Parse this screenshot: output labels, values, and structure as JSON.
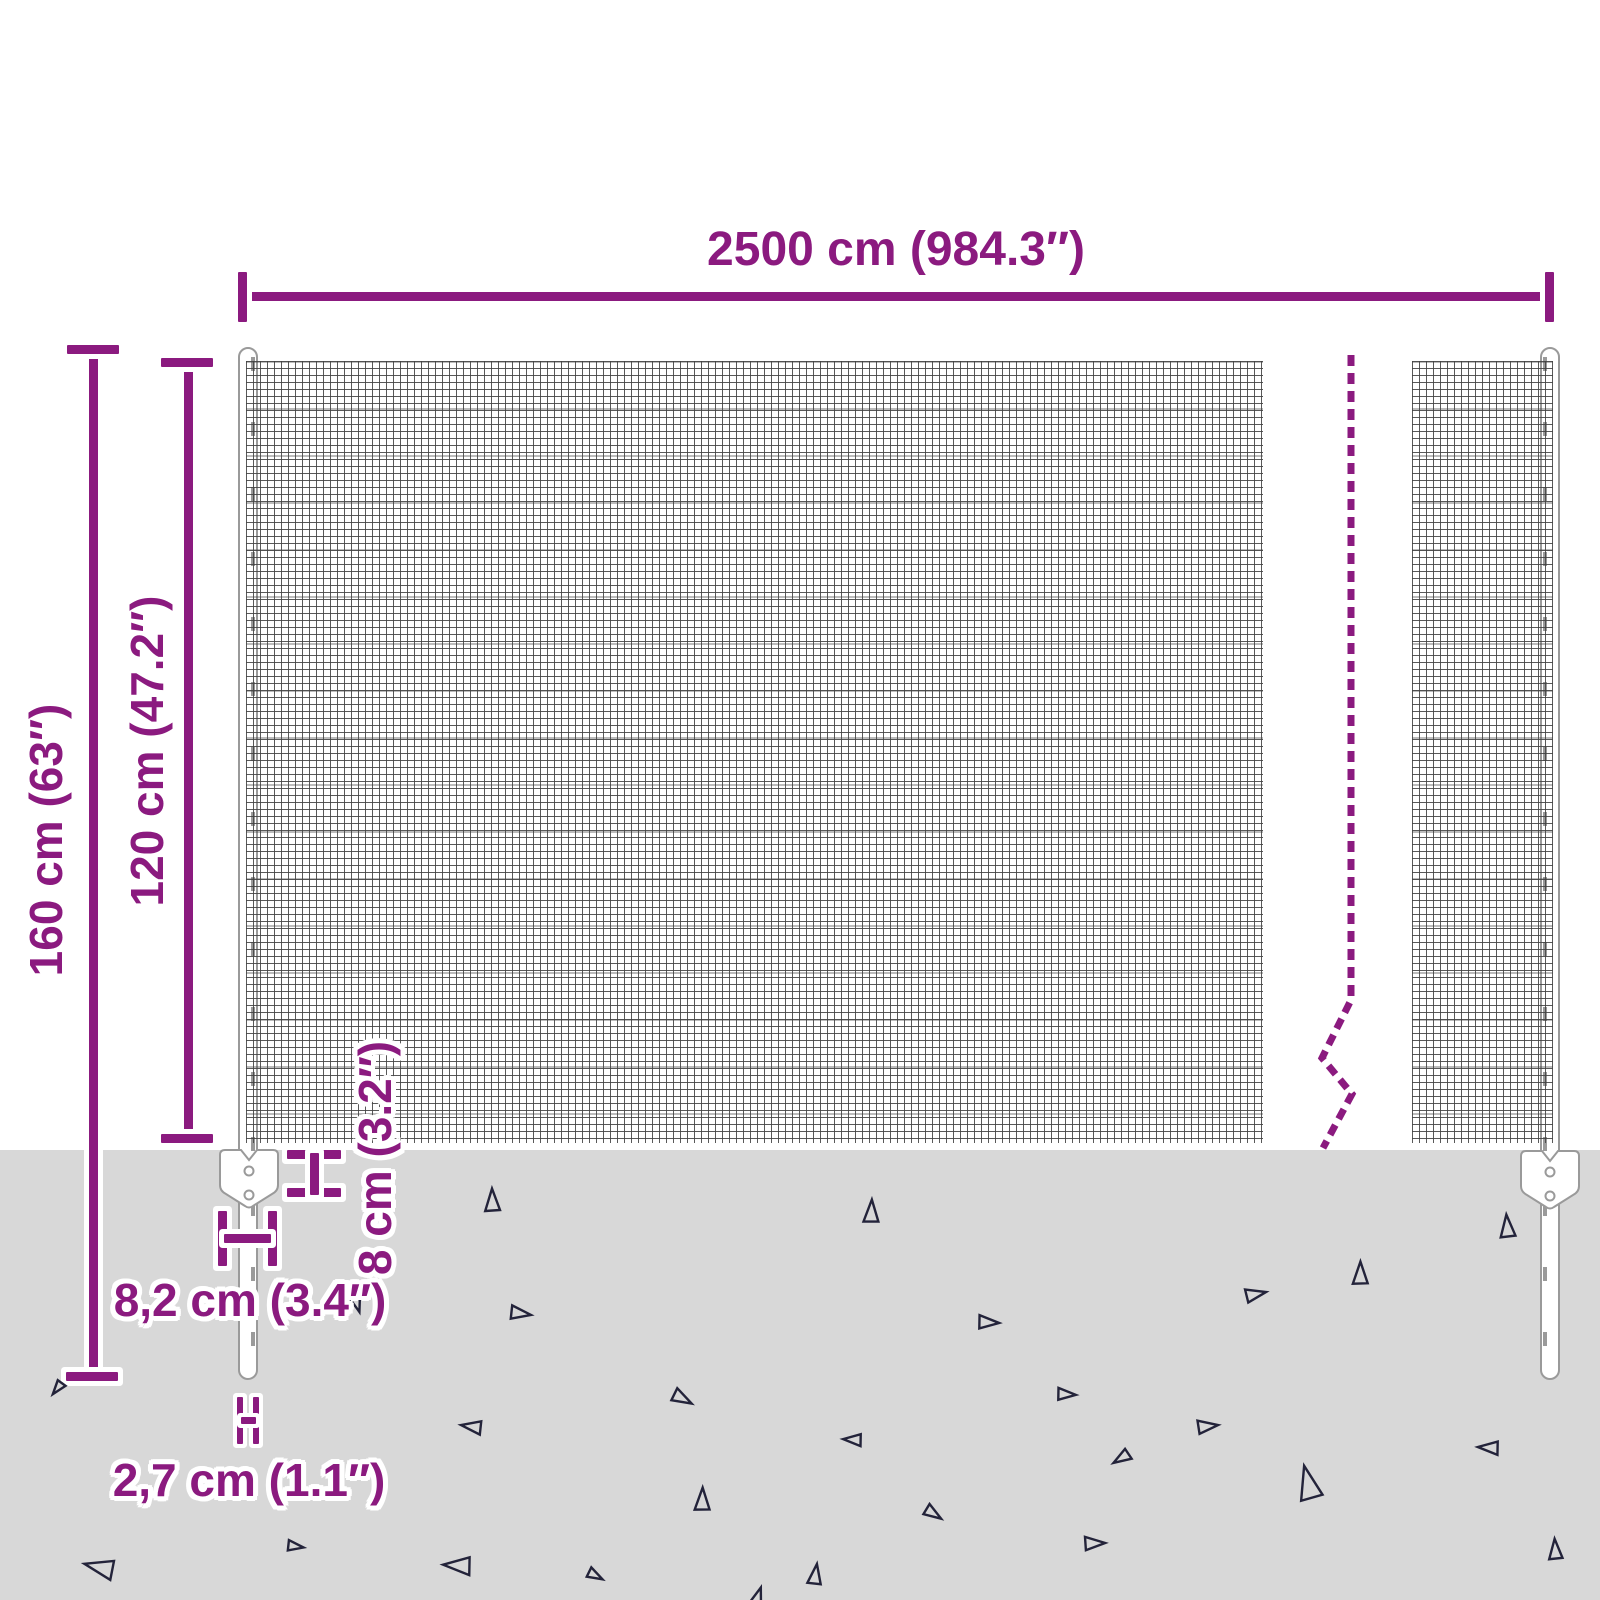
{
  "title": "Wire mesh fence dimension diagram",
  "colors": {
    "accent": "#8b1a7f",
    "ground": "#d8d8d8",
    "mesh_line": "#424242",
    "post_stroke": "#9a9a9a",
    "triangle_stroke": "#23233a"
  },
  "dimensions": {
    "total_width": {
      "label": "2500 cm (984.3″)"
    },
    "total_height": {
      "label": "160 cm (63″)"
    },
    "fence_height": {
      "label": "120 cm (47.2″)"
    },
    "ground_gap": {
      "label": "8 cm (3.2″)"
    },
    "anchor_plate_width": {
      "label": "8,2 cm (3.4″)"
    },
    "post_diameter": {
      "label": "2,7 cm (1.1″)"
    }
  },
  "ground": {
    "triangles": [
      {
        "x": 492,
        "y": 1201,
        "s": 20,
        "r": 0
      },
      {
        "x": 871,
        "y": 1212,
        "s": 20,
        "r": 4
      },
      {
        "x": 1507,
        "y": 1227,
        "s": 20,
        "r": -3
      },
      {
        "x": 1360,
        "y": 1274,
        "s": 20,
        "r": 2
      },
      {
        "x": 1255,
        "y": 1294,
        "s": 18,
        "r": 80
      },
      {
        "x": 988,
        "y": 1322,
        "s": 18,
        "r": 95
      },
      {
        "x": 520,
        "y": 1313,
        "s": 18,
        "r": 100
      },
      {
        "x": 357,
        "y": 1303,
        "s": 15,
        "r": 165
      },
      {
        "x": 1066,
        "y": 1394,
        "s": 16,
        "r": 95
      },
      {
        "x": 682,
        "y": 1398,
        "s": 18,
        "r": 120
      },
      {
        "x": 472,
        "y": 1427,
        "s": 18,
        "r": -80
      },
      {
        "x": 853,
        "y": 1440,
        "s": 16,
        "r": -85
      },
      {
        "x": 1207,
        "y": 1426,
        "s": 18,
        "r": 85
      },
      {
        "x": 1122,
        "y": 1458,
        "s": 16,
        "r": -120
      },
      {
        "x": 1489,
        "y": 1448,
        "s": 18,
        "r": -85
      },
      {
        "x": 1308,
        "y": 1484,
        "s": 30,
        "r": -12
      },
      {
        "x": 702,
        "y": 1500,
        "s": 20,
        "r": 3
      },
      {
        "x": 933,
        "y": 1513,
        "s": 16,
        "r": 125
      },
      {
        "x": 1094,
        "y": 1543,
        "s": 18,
        "r": 90
      },
      {
        "x": 1555,
        "y": 1550,
        "s": 18,
        "r": -2
      },
      {
        "x": 100,
        "y": 1568,
        "s": 26,
        "r": -75
      },
      {
        "x": 295,
        "y": 1546,
        "s": 14,
        "r": 100
      },
      {
        "x": 458,
        "y": 1566,
        "s": 24,
        "r": -85
      },
      {
        "x": 595,
        "y": 1575,
        "s": 14,
        "r": 120
      },
      {
        "x": 815,
        "y": 1575,
        "s": 18,
        "r": 10
      },
      {
        "x": 58,
        "y": 1388,
        "s": 13,
        "r": -140
      },
      {
        "x": 757,
        "y": 1598,
        "s": 18,
        "r": 20
      }
    ]
  }
}
